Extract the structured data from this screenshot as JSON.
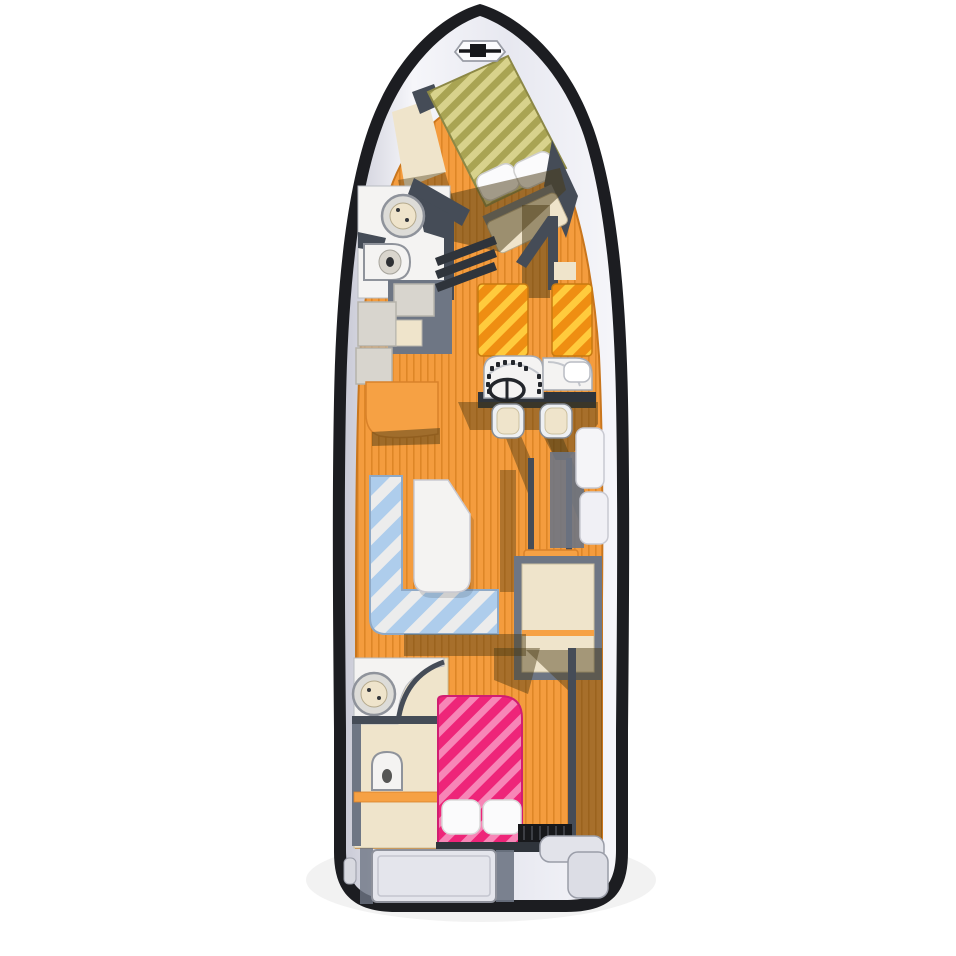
{
  "illustration": {
    "kind": "yacht-deck-floorplan",
    "orientation": "bow-up"
  },
  "colors": {
    "page_bg": "#ffffff",
    "hull_outline": "#1c1d21",
    "deck_edge_light": "#f6f6fa",
    "deck_base": "#e7e8f0",
    "deck_shade": "#c9cad6",
    "wall_dark": "#454c57",
    "wall_mid": "#6e7684",
    "wall_deep": "#2f343b",
    "floor_orange": "#f49c3e",
    "floor_orange_stripe": "#de8627",
    "floor_orange_edge": "#c9761d",
    "cabinet_orange": "#f6a144",
    "cabinet_orange_edge": "#d9822a",
    "shadow_brown": "#4a3a14",
    "berth_olive_light": "#d8d28c",
    "berth_olive_dark": "#a9a453",
    "berth_olive_edge": "#6d6535",
    "bed_orange_light": "#ffcb3d",
    "bed_orange_dark": "#ef8e12",
    "bed_pink_light": "#f786b7",
    "bed_pink_dark": "#ee2579",
    "bed_pink_edge": "#d01e72",
    "sofa_blue": "#aecdec",
    "sofa_blue_pale": "#ececec",
    "sofa_edge": "#8fa9c6",
    "upholstery_beige": "#efe4cb",
    "upholstery_edge": "#cbbf9f",
    "fixture_white": "#f4f3f2",
    "fixture_edge": "#9aa0a8",
    "tile_gray": "#d8d5ce",
    "tile_edge": "#b6b3ab",
    "hatch_gray": "#e4e5ec",
    "grate_black": "#17181b",
    "steel_dark": "#23262b",
    "pillow_white": "#fbfbfc"
  }
}
